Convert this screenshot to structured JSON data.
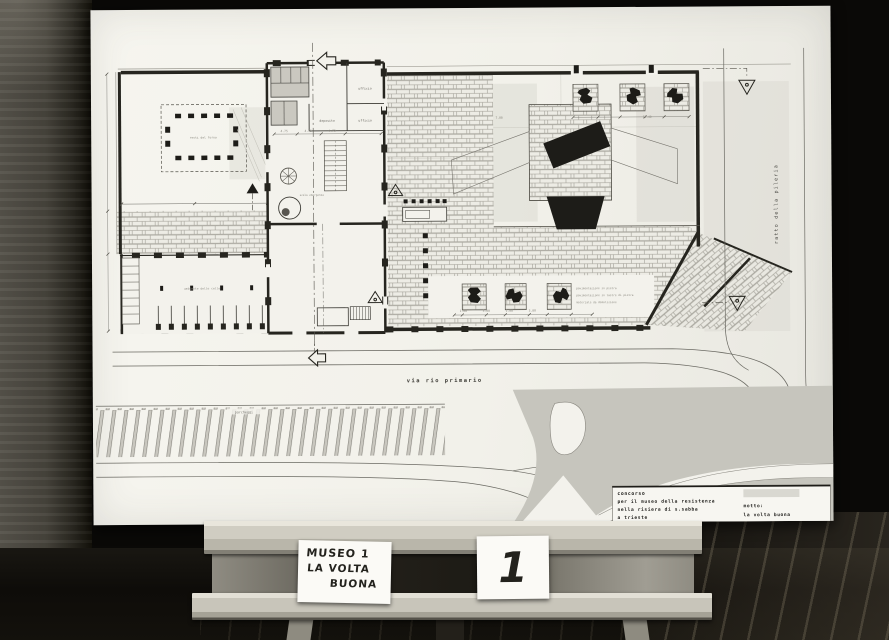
{
  "colors": {
    "photo_background": "#0a0907",
    "wall_strip": "#56534b",
    "floor": "#13110c",
    "floor_plank_light": "#968c74",
    "board_paper": "#f3f2ec",
    "plan_ink": "#26251f",
    "brick_line": "#9b9990",
    "shadow_wash": "#c6c5bd",
    "easel_wood": "#cdcabf",
    "card_paper": "#fbfaf6"
  },
  "board": {
    "title_block": {
      "line1": "concorso",
      "line2": "per il museo della resistenza",
      "line3": "nella risiera di s.sabba",
      "line4": "a trieste",
      "motto_label": "motto:",
      "motto_value": "la volta buona"
    },
    "plan": {
      "street_label": "via rio primario",
      "side_label": "ratto della pileria",
      "labels": {
        "ufficio_top": "ufficio",
        "ufficio_mid": "ufficio",
        "deposito": "deposito",
        "parcheggi": "parcheggi",
        "resti_forno": "resti del forno",
        "scala_emergenza": "scala emergenza",
        "celle": "ambiente delle celle",
        "note_1": "pavimentazione in pietra",
        "note_2": "pavimentazione in lastre di pietra",
        "note_3": "materiale da demolizione"
      },
      "dims": [
        "4.75",
        "4.75",
        "4.75",
        "1.00",
        "3.00",
        "1.00",
        "3.00",
        "7.00",
        "13.40"
      ]
    }
  },
  "easel": {
    "card_title": {
      "line1": "MUSEO 1",
      "line2": "LA VOLTA",
      "line3": "BUONA"
    },
    "card_number": {
      "digit": "1"
    }
  }
}
